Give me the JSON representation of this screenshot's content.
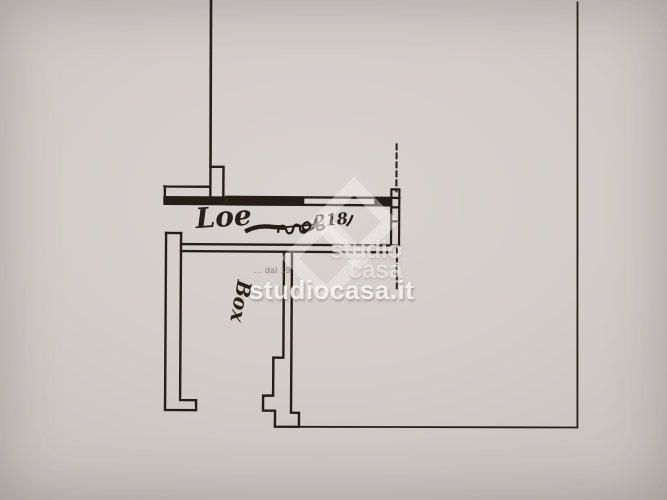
{
  "plan": {
    "labels": {
      "loc": "Loe",
      "box": "Box",
      "note_number": "218"
    }
  },
  "watermark": {
    "brand_line1": "studio",
    "brand_line2": "casa",
    "tagline": "... dal 19",
    "site": "studiocasa.it"
  },
  "colors": {
    "paper": "#cfc8c5",
    "ink": "#251e18",
    "watermark_white": "#f7f4f2"
  }
}
